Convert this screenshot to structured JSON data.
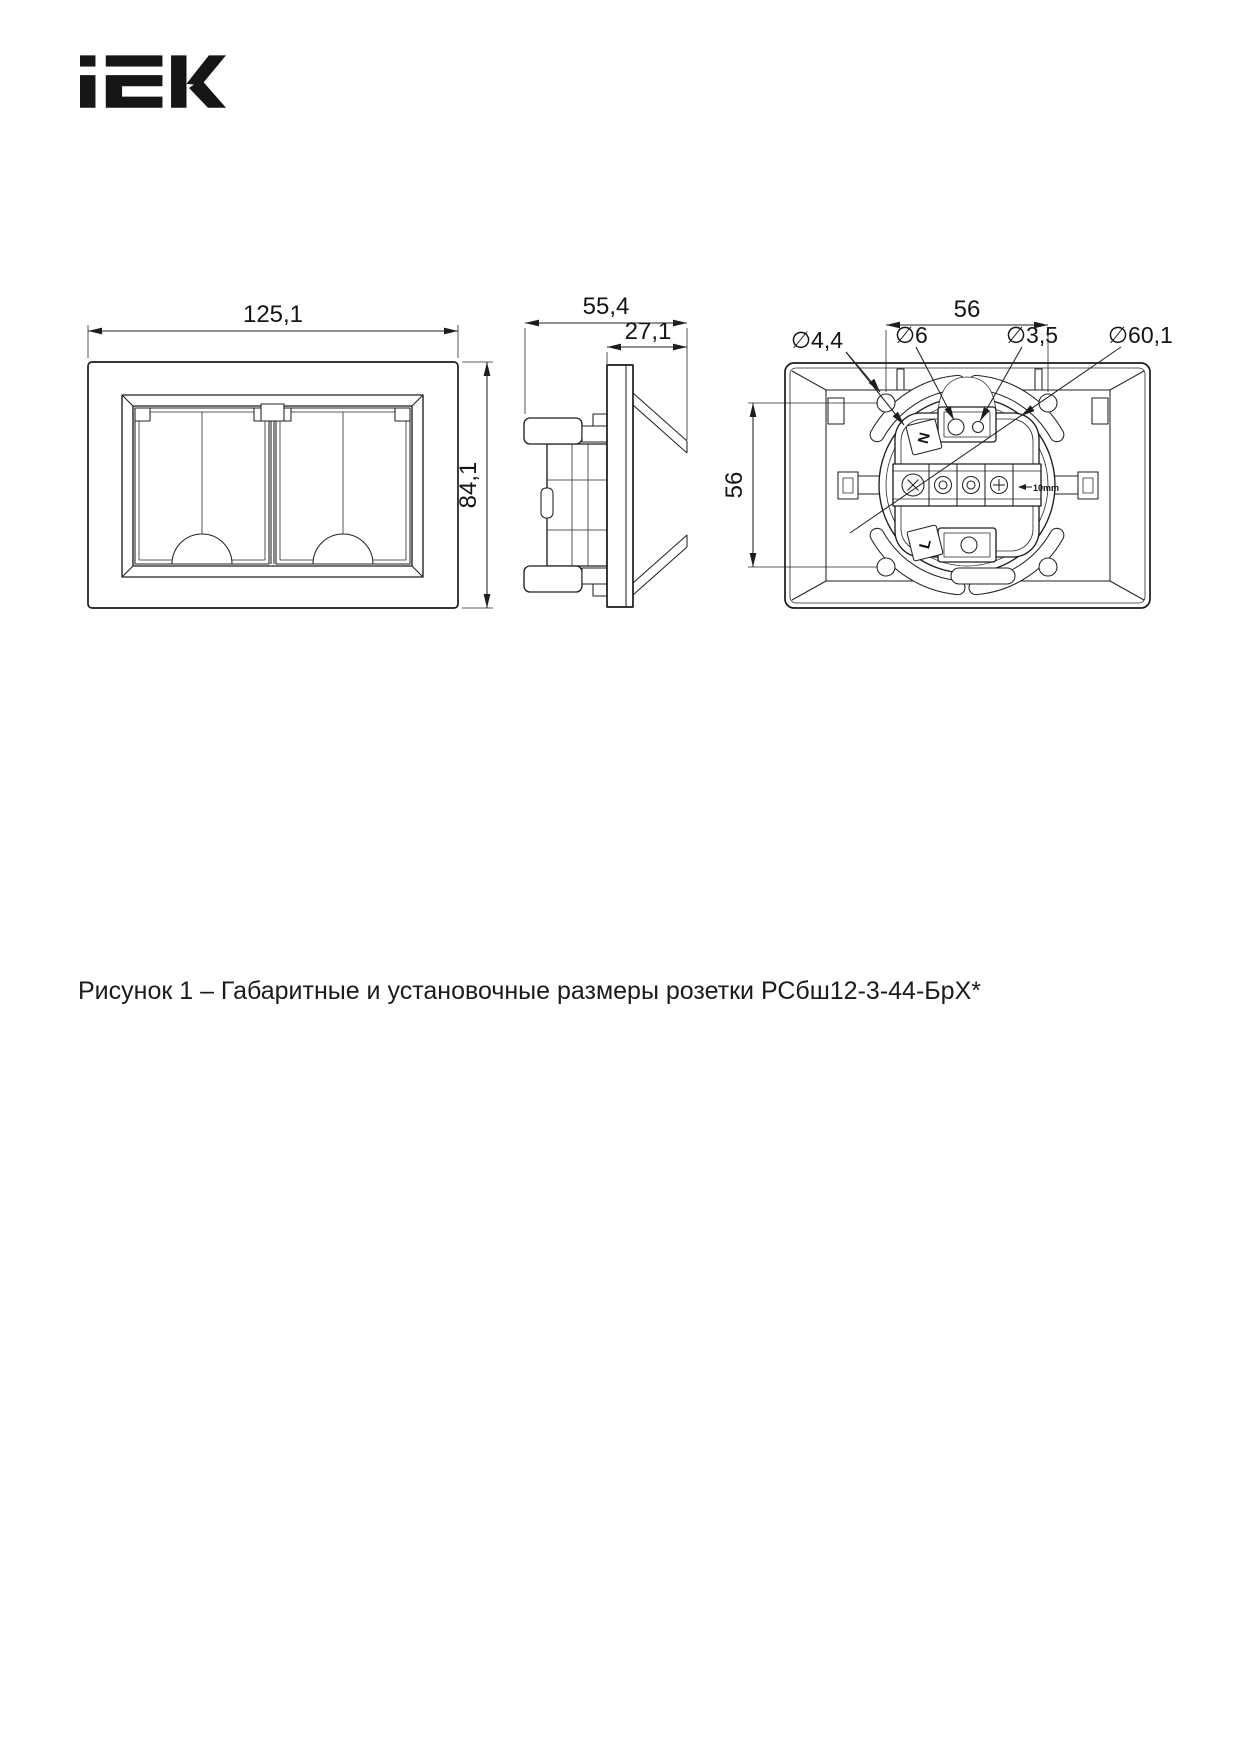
{
  "brand": {
    "logo_text": "IEK"
  },
  "figure": {
    "caption": "Рисунок 1 – Габаритные и установочные размеры розетки РСбш12-3-44-БрХ*"
  },
  "views": {
    "front": {
      "dim_width": "125,1",
      "dim_height": "84,1"
    },
    "side": {
      "dim_depth_total": "55,4",
      "dim_depth_front": "27,1"
    },
    "back": {
      "dim_mount_pitch_h": "56",
      "dim_mount_pitch_v": "56",
      "dim_corner_hole": "∅4,4",
      "dim_top_hole": "∅6",
      "dim_screw_hole": "∅3,5",
      "dim_cup": "∅60,1",
      "terminal_n": "N",
      "terminal_l": "L",
      "strip_length": "10mm"
    }
  }
}
